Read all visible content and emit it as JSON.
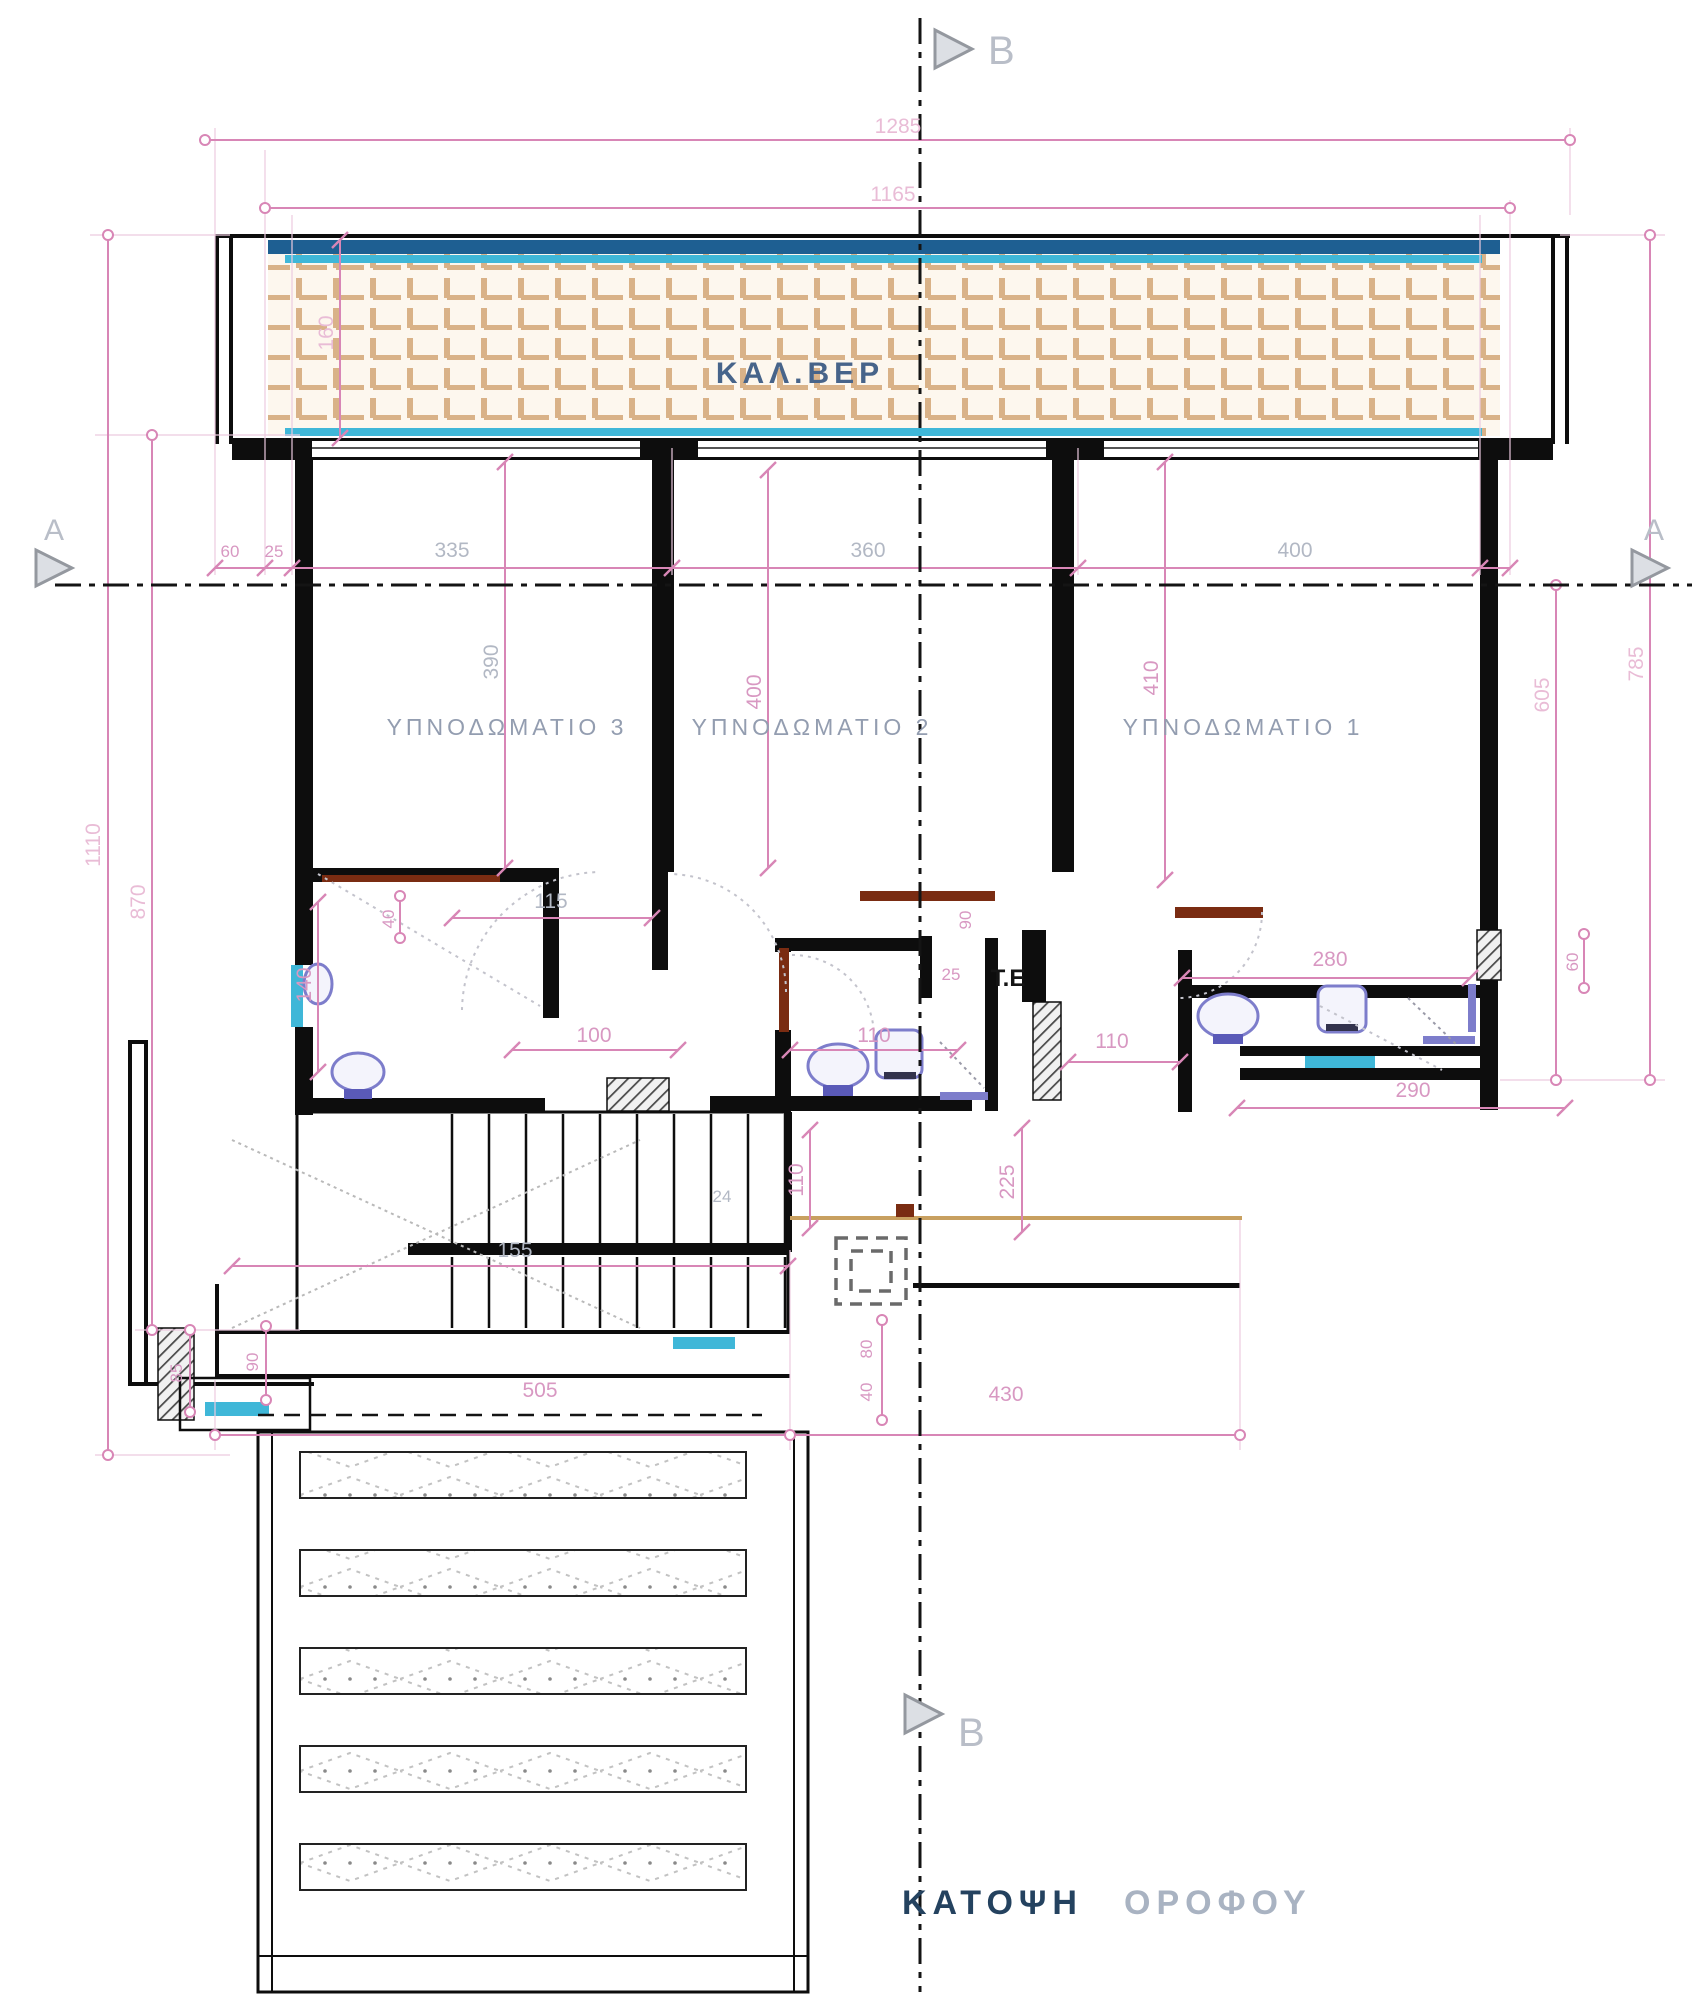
{
  "title": {
    "part1": "ΚΑΤΟΨΗ",
    "part2": "ΟΡΟΦΟΥ"
  },
  "section": {
    "a": "A",
    "b": "B"
  },
  "rooms": {
    "veranda": "ΚΑΛ.ΒΕΡ",
    "bedroom3": "ΥΠΝΟΔΩΜΑΤΙΟ 3",
    "bedroom2": "ΥΠΝΟΔΩΜΑΤΙΟ 2",
    "bedroom1": "ΥΠΝΟΔΩΜΑΤΙΟ 1",
    "te": "Τ.Ε"
  },
  "dims": {
    "top_outer": "1285",
    "top_inner": "1165",
    "left_outer": "1110",
    "left_inner": "870",
    "right_outer": "785",
    "right_inner": "605",
    "veranda_h": "160",
    "w60": "60",
    "w25": "25",
    "bed3_w": "335",
    "bed2_w": "360",
    "bed1_w": "400",
    "bed3_d": "390",
    "bed2_d": "400",
    "bed1_d": "410",
    "d115": "115",
    "d140": "140",
    "d40": "40",
    "d100": "100",
    "d110_hall": "110",
    "d25": "25",
    "d90": "90",
    "d280": "280",
    "d60": "60",
    "d290": "290",
    "d110_bath": "110",
    "d225": "225",
    "d110_stair": "110",
    "d24": "24",
    "d155": "155",
    "d505": "505",
    "d430": "430",
    "d80": "80",
    "d40_b": "40",
    "d85": "85",
    "d90_b": "90"
  },
  "colors": {
    "dimension_pink": "#d886b6",
    "wall_black": "#0d0d0d",
    "tile_tan": "#d9b288",
    "window_cyan": "#3fb7d8",
    "navy_band": "#1e5f92",
    "fixture_purple": "#7d7dcb",
    "door_brown": "#7a2c12",
    "title_dark": "#24425f",
    "title_light": "#a9b3c2"
  }
}
